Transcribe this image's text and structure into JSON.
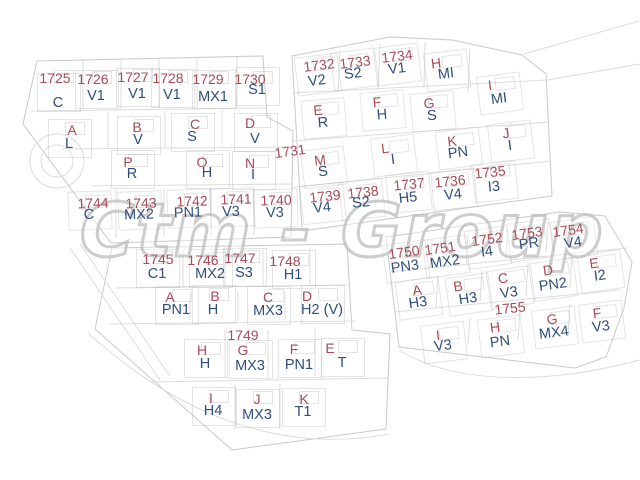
{
  "watermark": {
    "text": "Ctm - Group"
  },
  "map": {
    "background": "#ffffff",
    "number_color": "#a64c57",
    "code_color": "#2e4e7c",
    "line_color": "#d7d7d7",
    "boundary_color": "#c9c9c9",
    "watermark_color": "#bababa"
  },
  "parcels": [
    {
      "num": "1725",
      "code": "C",
      "nx": 55,
      "ny": 78,
      "cx": 58,
      "cy": 103,
      "r": 0
    },
    {
      "num": "1726",
      "code": "V1",
      "nx": 93,
      "ny": 79,
      "cx": 96,
      "cy": 96,
      "r": 0
    },
    {
      "num": "1727",
      "code": "V1",
      "nx": 133,
      "ny": 77,
      "cx": 137,
      "cy": 94,
      "r": 0
    },
    {
      "num": "1728",
      "code": "V1",
      "nx": 168,
      "ny": 78,
      "cx": 172,
      "cy": 95,
      "r": 0
    },
    {
      "num": "1729",
      "code": "MX1",
      "nx": 208,
      "ny": 79,
      "cx": 213,
      "cy": 97,
      "r": 0
    },
    {
      "num": "1730",
      "code": "S1",
      "nx": 250,
      "ny": 79,
      "cx": 257,
      "cy": 90,
      "r": 0
    },
    {
      "num": "A",
      "code": "L",
      "nx": 72,
      "ny": 130,
      "cx": 69,
      "cy": 144,
      "r": 0
    },
    {
      "num": "B",
      "code": "V",
      "nx": 137,
      "ny": 127,
      "cx": 138,
      "cy": 140,
      "r": 0
    },
    {
      "num": "C",
      "code": "S",
      "nx": 195,
      "ny": 124,
      "cx": 192,
      "cy": 137,
      "r": 0
    },
    {
      "num": "D",
      "code": "V",
      "nx": 250,
      "ny": 123,
      "cx": 255,
      "cy": 139,
      "r": 0
    },
    {
      "num": "P",
      "code": "R",
      "nx": 128,
      "ny": 162,
      "cx": 132,
      "cy": 174,
      "r": 0
    },
    {
      "num": "O",
      "code": "H",
      "nx": 202,
      "ny": 162,
      "cx": 207,
      "cy": 173,
      "r": 0
    },
    {
      "num": "N",
      "code": "I",
      "nx": 250,
      "ny": 163,
      "cx": 253,
      "cy": 175,
      "r": 0
    },
    {
      "num": "1731",
      "code": null,
      "nx": 290,
      "ny": 151,
      "cx": 0,
      "cy": 0,
      "r": -8
    },
    {
      "num": "1744",
      "code": "C",
      "nx": 93,
      "ny": 203,
      "cx": 89,
      "cy": 215,
      "r": -2
    },
    {
      "num": "1743",
      "code": "MX2",
      "nx": 141,
      "ny": 203,
      "cx": 139,
      "cy": 215,
      "r": -2
    },
    {
      "num": "1742",
      "code": "PN1",
      "nx": 192,
      "ny": 201,
      "cx": 188,
      "cy": 213,
      "r": -2
    },
    {
      "num": "1741",
      "code": "V3",
      "nx": 236,
      "ny": 199,
      "cx": 231,
      "cy": 212,
      "r": -2
    },
    {
      "num": "1740",
      "code": "V3",
      "nx": 276,
      "ny": 200,
      "cx": 275,
      "cy": 213,
      "r": -2
    },
    {
      "num": "1732",
      "code": "V2",
      "nx": 319,
      "ny": 65,
      "cx": 317,
      "cy": 81,
      "r": -7
    },
    {
      "num": "1733",
      "code": "S2",
      "nx": 355,
      "ny": 62,
      "cx": 353,
      "cy": 74,
      "r": -7
    },
    {
      "num": "1734",
      "code": "V1",
      "nx": 397,
      "ny": 56,
      "cx": 397,
      "cy": 69,
      "r": -7
    },
    {
      "num": "H",
      "code": "MI",
      "nx": 436,
      "ny": 63,
      "cx": 446,
      "cy": 74,
      "r": -7
    },
    {
      "num": "I",
      "code": "MI",
      "nx": 490,
      "ny": 85,
      "cx": 499,
      "cy": 99,
      "r": -7
    },
    {
      "num": "E",
      "code": "R",
      "nx": 318,
      "ny": 110,
      "cx": 323,
      "cy": 123,
      "r": -5
    },
    {
      "num": "F",
      "code": "H",
      "nx": 377,
      "ny": 102,
      "cx": 382,
      "cy": 115,
      "r": -5
    },
    {
      "num": "G",
      "code": "S",
      "nx": 429,
      "ny": 103,
      "cx": 432,
      "cy": 116,
      "r": -5
    },
    {
      "num": "M",
      "code": "S",
      "nx": 320,
      "ny": 160,
      "cx": 323,
      "cy": 172,
      "r": -7
    },
    {
      "num": "L",
      "code": "I",
      "nx": 385,
      "ny": 148,
      "cx": 393,
      "cy": 160,
      "r": -7
    },
    {
      "num": "K",
      "code": "PN",
      "nx": 452,
      "ny": 141,
      "cx": 458,
      "cy": 153,
      "r": -7
    },
    {
      "num": "J",
      "code": "I",
      "nx": 506,
      "ny": 133,
      "cx": 510,
      "cy": 146,
      "r": -7
    },
    {
      "num": "1739",
      "code": "V4",
      "nx": 325,
      "ny": 196,
      "cx": 322,
      "cy": 208,
      "r": -6
    },
    {
      "num": "1738",
      "code": "S2",
      "nx": 363,
      "ny": 192,
      "cx": 361,
      "cy": 203,
      "r": -6
    },
    {
      "num": "1737",
      "code": "H5",
      "nx": 409,
      "ny": 184,
      "cx": 408,
      "cy": 198,
      "r": -6
    },
    {
      "num": "1736",
      "code": "V4",
      "nx": 450,
      "ny": 181,
      "cx": 453,
      "cy": 195,
      "r": -6
    },
    {
      "num": "1735",
      "code": "I3",
      "nx": 490,
      "ny": 172,
      "cx": 494,
      "cy": 187,
      "r": -6
    },
    {
      "num": "1745",
      "code": "C1",
      "nx": 158,
      "ny": 259,
      "cx": 157,
      "cy": 274,
      "r": 0
    },
    {
      "num": "1746",
      "code": "MX2",
      "nx": 203,
      "ny": 260,
      "cx": 210,
      "cy": 274,
      "r": 0
    },
    {
      "num": "1747",
      "code": "S3",
      "nx": 240,
      "ny": 258,
      "cx": 244,
      "cy": 273,
      "r": 0
    },
    {
      "num": "1748",
      "code": "H1",
      "nx": 285,
      "ny": 261,
      "cx": 293,
      "cy": 275,
      "r": 0
    },
    {
      "num": "A",
      "code": "PN1",
      "nx": 170,
      "ny": 297,
      "cx": 176,
      "cy": 310,
      "r": 0
    },
    {
      "num": "B",
      "code": "H",
      "nx": 215,
      "ny": 296,
      "cx": 213,
      "cy": 310,
      "r": 0
    },
    {
      "num": "C",
      "code": "MX3",
      "nx": 268,
      "ny": 297,
      "cx": 268,
      "cy": 311,
      "r": 0
    },
    {
      "num": "D",
      "code": "H2 (V)",
      "nx": 307,
      "ny": 296,
      "cx": 322,
      "cy": 310,
      "r": 0
    },
    {
      "num": "1749",
      "code": null,
      "nx": 243,
      "ny": 335,
      "cx": 0,
      "cy": 0,
      "r": 0
    },
    {
      "num": "H",
      "code": "H",
      "nx": 202,
      "ny": 350,
      "cx": 205,
      "cy": 364,
      "r": 0
    },
    {
      "num": "G",
      "code": "MX3",
      "nx": 243,
      "ny": 350,
      "cx": 250,
      "cy": 366,
      "r": 0
    },
    {
      "num": "F",
      "code": "PN1",
      "nx": 294,
      "ny": 349,
      "cx": 299,
      "cy": 365,
      "r": 0
    },
    {
      "num": "E",
      "code": "T",
      "nx": 330,
      "ny": 348,
      "cx": 342,
      "cy": 363,
      "r": 0
    },
    {
      "num": "I",
      "code": "H4",
      "nx": 211,
      "ny": 398,
      "cx": 213,
      "cy": 411,
      "r": 0
    },
    {
      "num": "J",
      "code": "MX3",
      "nx": 257,
      "ny": 399,
      "cx": 257,
      "cy": 415,
      "r": 0
    },
    {
      "num": "K",
      "code": "T1",
      "nx": 304,
      "ny": 399,
      "cx": 303,
      "cy": 412,
      "r": 0
    },
    {
      "num": "1750",
      "code": "PN3",
      "nx": 404,
      "ny": 252,
      "cx": 405,
      "cy": 267,
      "r": -8
    },
    {
      "num": "1751",
      "code": "MX2",
      "nx": 440,
      "ny": 248,
      "cx": 445,
      "cy": 262,
      "r": -8
    },
    {
      "num": "1752",
      "code": "I4",
      "nx": 487,
      "ny": 239,
      "cx": 487,
      "cy": 252,
      "r": -8
    },
    {
      "num": "1753",
      "code": "PR",
      "nx": 527,
      "ny": 233,
      "cx": 529,
      "cy": 244,
      "r": -8
    },
    {
      "num": "1754",
      "code": "V4",
      "nx": 568,
      "ny": 230,
      "cx": 573,
      "cy": 243,
      "r": -8
    },
    {
      "num": "A",
      "code": "H3",
      "nx": 417,
      "ny": 290,
      "cx": 418,
      "cy": 303,
      "r": -8
    },
    {
      "num": "B",
      "code": "H3",
      "nx": 458,
      "ny": 286,
      "cx": 468,
      "cy": 299,
      "r": -8
    },
    {
      "num": "C",
      "code": "V3",
      "nx": 503,
      "ny": 278,
      "cx": 509,
      "cy": 293,
      "r": -8
    },
    {
      "num": "D",
      "code": "PN2",
      "nx": 548,
      "ny": 270,
      "cx": 553,
      "cy": 285,
      "r": -8
    },
    {
      "num": "E",
      "code": "I2",
      "nx": 594,
      "ny": 263,
      "cx": 600,
      "cy": 276,
      "r": -8
    },
    {
      "num": "1755",
      "code": null,
      "nx": 510,
      "ny": 308,
      "cx": 0,
      "cy": 0,
      "r": -6
    },
    {
      "num": "I",
      "code": "V3",
      "nx": 438,
      "ny": 335,
      "cx": 443,
      "cy": 346,
      "r": -7
    },
    {
      "num": "H",
      "code": "PN",
      "nx": 495,
      "ny": 327,
      "cx": 500,
      "cy": 342,
      "r": -7
    },
    {
      "num": "G",
      "code": "MX4",
      "nx": 552,
      "ny": 319,
      "cx": 554,
      "cy": 333,
      "r": -7
    },
    {
      "num": "F",
      "code": "V3",
      "nx": 597,
      "ny": 313,
      "cx": 601,
      "cy": 327,
      "r": -7
    }
  ]
}
